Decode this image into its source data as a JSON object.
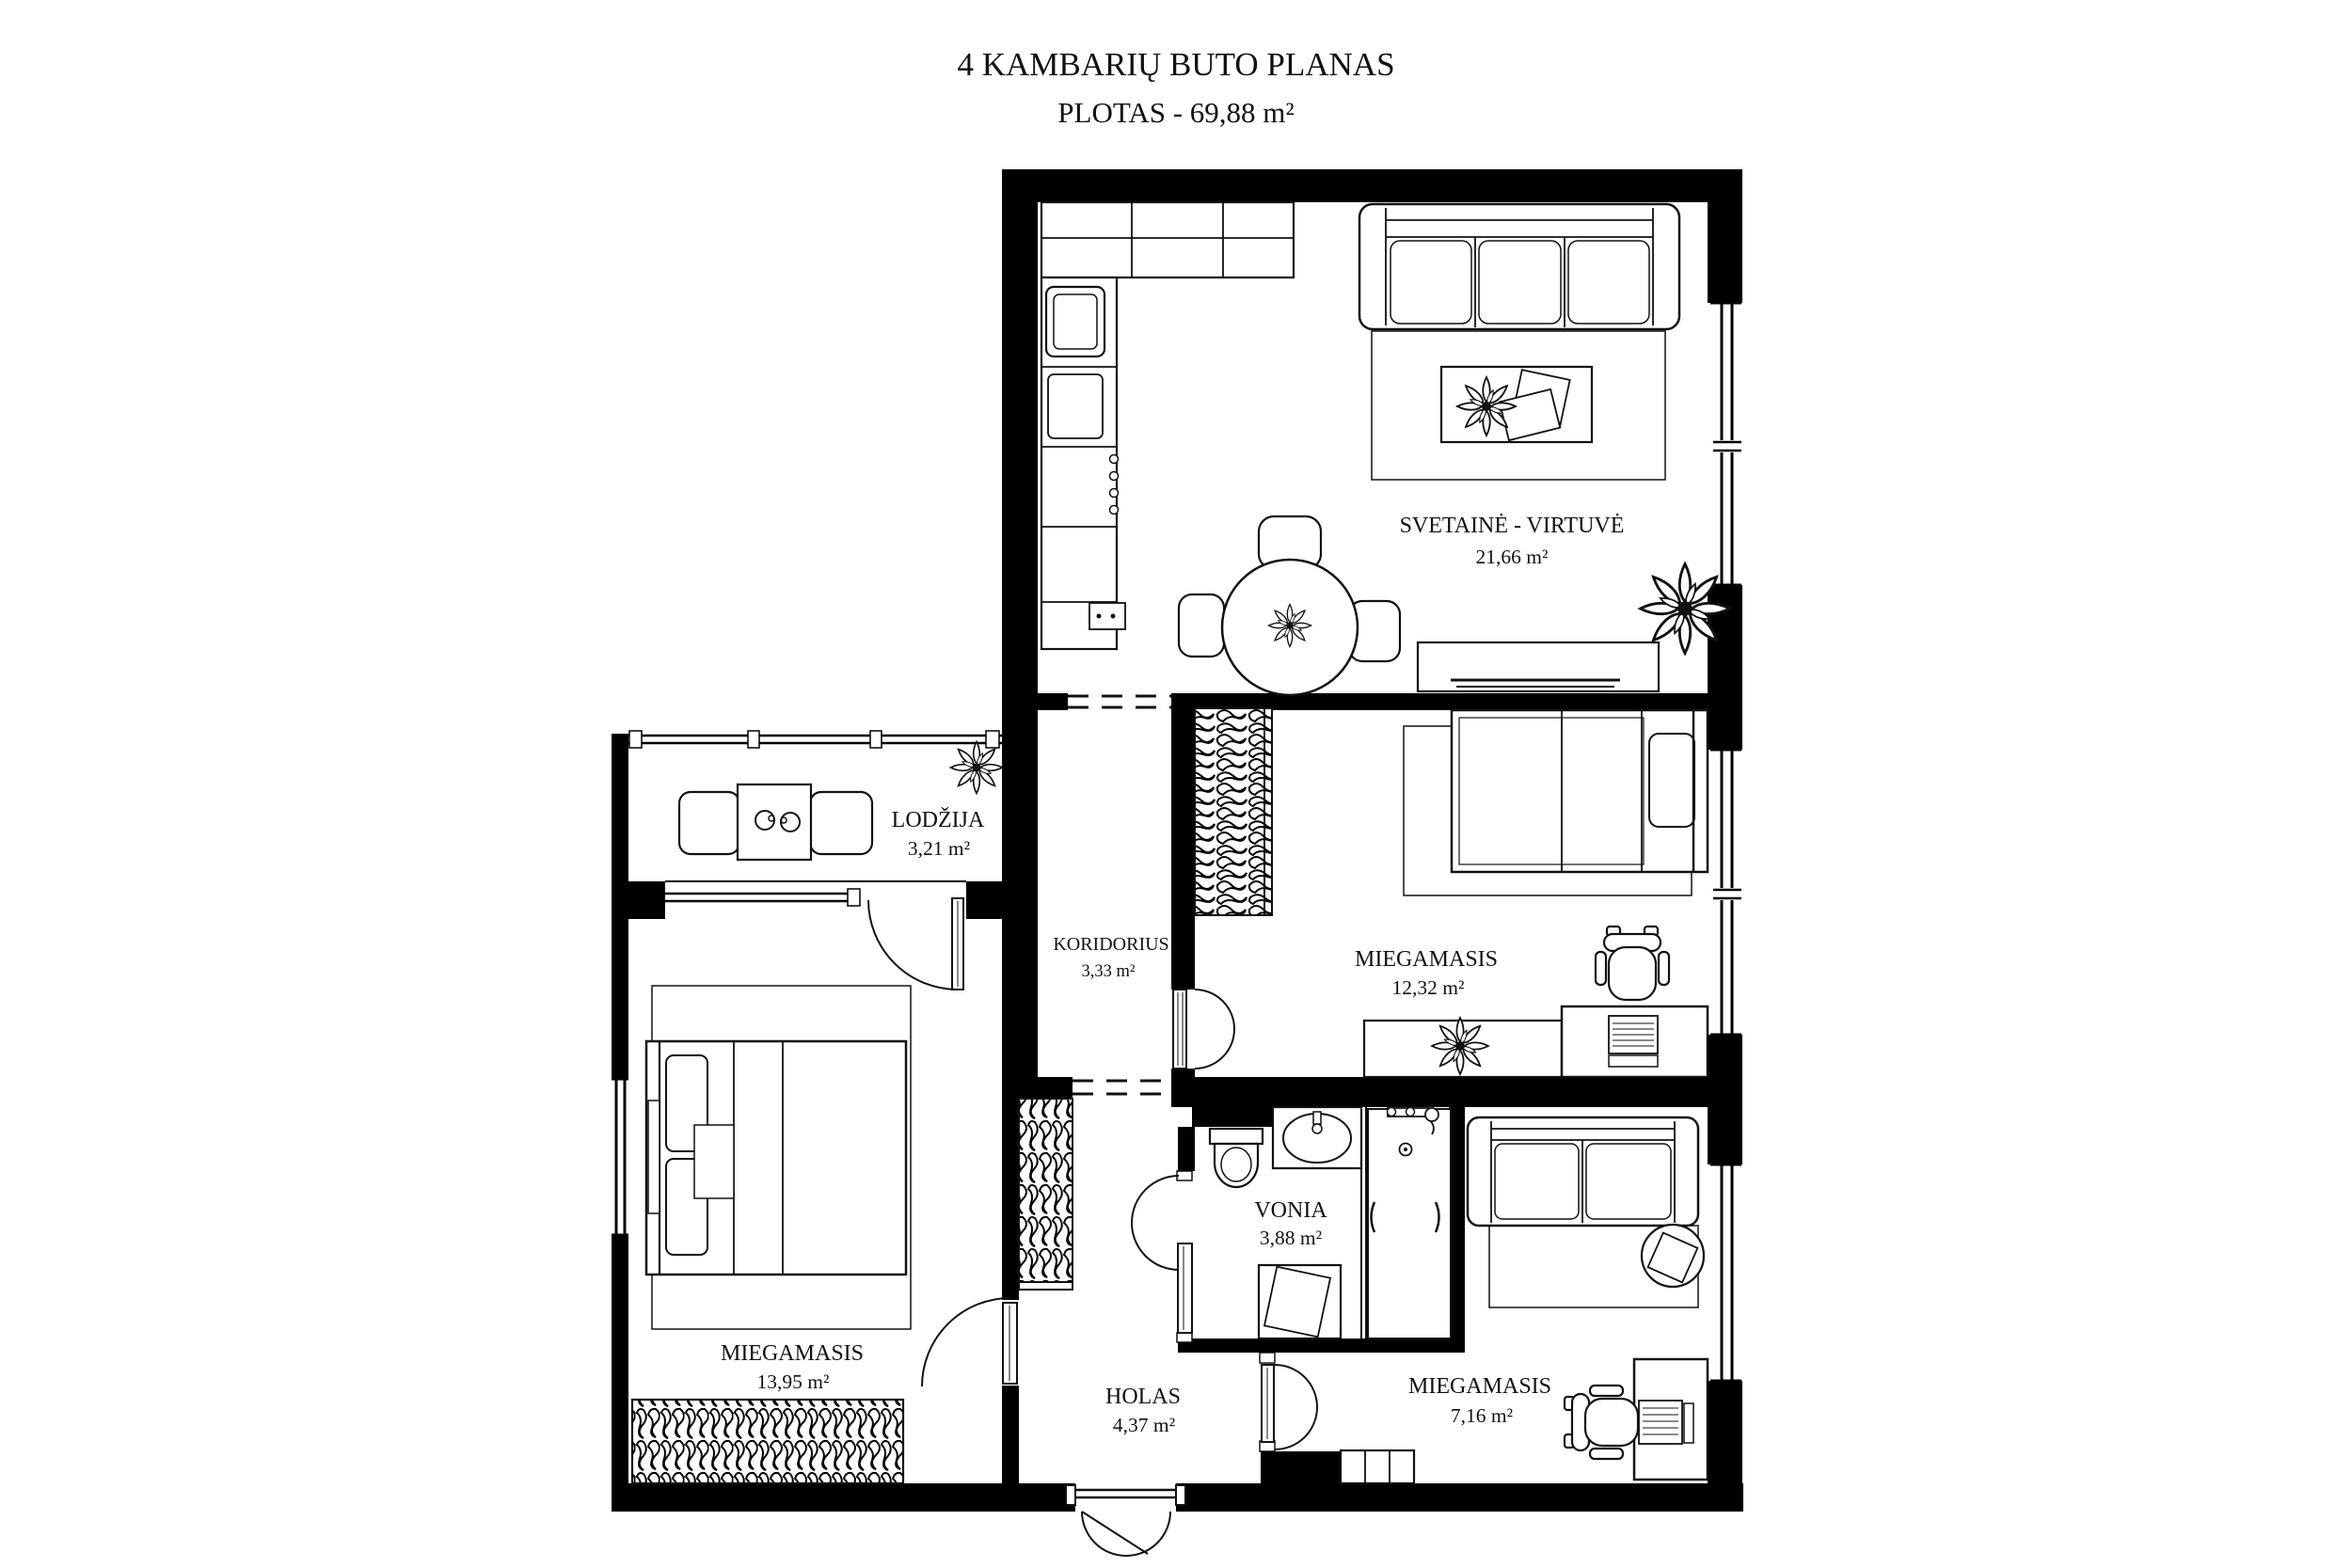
{
  "title": {
    "line1": "4 KAMBARIŲ BUTO PLANAS",
    "line2": "PLOTAS - 69,88 m²"
  },
  "rooms": {
    "living": {
      "name": "SVETAINĖ - VIRTUVĖ",
      "area": "21,66 m²"
    },
    "loggia": {
      "name": "LODŽIJA",
      "area": "3,21 m²"
    },
    "corridor": {
      "name": "KORIDORIUS",
      "area": "3,33 m²"
    },
    "bedroom_right": {
      "name": "MIEGAMASIS",
      "area": "12,32 m²"
    },
    "bedroom_left": {
      "name": "MIEGAMASIS",
      "area": "13,95 m²"
    },
    "bathroom": {
      "name": "VONIA",
      "area": "3,88 m²"
    },
    "hall": {
      "name": "HOLAS",
      "area": "4,37 m²"
    },
    "bedroom_small": {
      "name": "MIEGAMASIS",
      "area": "7,16 m²"
    }
  },
  "colors": {
    "wall": "#000000",
    "line": "#111111",
    "background": "#ffffff"
  }
}
